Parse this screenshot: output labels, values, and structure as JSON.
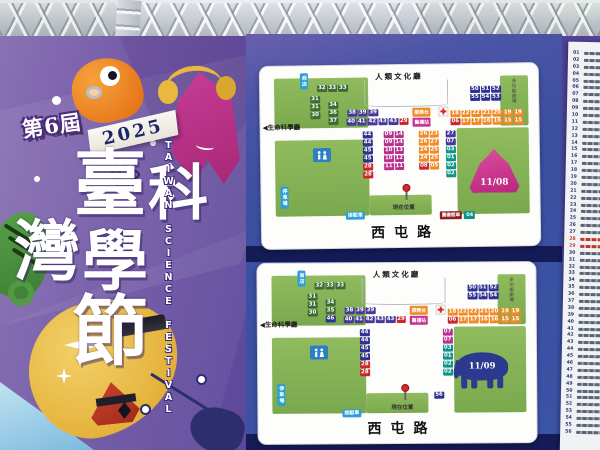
{
  "poster": {
    "edition_badge": "第6屆",
    "year_ribbon": "2025",
    "title_char_1": "臺",
    "title_char_2": "科",
    "title_char_3": "灣",
    "title_char_4": "學",
    "title_char_5": "節",
    "english_vertical": "TAIWAN SCIENCE FESTIVAL"
  },
  "booth_colors": {
    "g": "#3e6b35",
    "n": "#2e3192",
    "p": "#46399b",
    "o": "#f08a24",
    "r": "#c9252c",
    "m": "#b82f8e",
    "t": "#0f9288"
  },
  "maps": [
    {
      "date": "11/08",
      "mascot": "mountain",
      "labels": {
        "hall_top": "人類文化廳",
        "hall_left": "◀生命科學廳",
        "shop": "商店",
        "parking": "停車場",
        "shuttle": "接駁車",
        "service": "服務台",
        "medical": "醫護站",
        "theater": "多功能劇場",
        "current": "現在位置",
        "road": "西屯路",
        "library": "圖書館車",
        "library_no": "04"
      },
      "groups": [
        {
          "name": "shop-row",
          "x": 57,
          "y": 19,
          "cols": 3,
          "cells": [
            [
              "32",
              "g"
            ],
            [
              "33",
              "g"
            ],
            [
              "33",
              "g"
            ]
          ]
        },
        {
          "name": "col-a",
          "x": 50,
          "y": 30,
          "cols": 1,
          "cells": [
            [
              "31",
              "g"
            ],
            [
              "31",
              "g"
            ],
            [
              "30",
              "g"
            ]
          ]
        },
        {
          "name": "col-b",
          "x": 68,
          "y": 36,
          "cols": 1,
          "cells": [
            [
              "34",
              "g"
            ],
            [
              "36",
              "g"
            ],
            [
              "37",
              "g"
            ]
          ]
        },
        {
          "name": "purple-row-1",
          "x": 87,
          "y": 44,
          "cols": 3,
          "cells": [
            [
              "38",
              "p"
            ],
            [
              "39",
              "p"
            ],
            [
              "39",
              "p"
            ]
          ]
        },
        {
          "name": "purple-row-2",
          "x": 86,
          "y": 53,
          "cols": 6,
          "cells": [
            [
              "40",
              "p"
            ],
            [
              "41",
              "p"
            ],
            [
              "42",
              "p"
            ],
            [
              "43",
              "p"
            ],
            [
              "43",
              "p"
            ],
            [
              "29",
              "r"
            ]
          ]
        },
        {
          "name": "navy-grid",
          "x": 210,
          "y": 22,
          "cols": 3,
          "cells": [
            [
              "50",
              "n"
            ],
            [
              "51",
              "n"
            ],
            [
              "52",
              "n"
            ],
            [
              "55",
              "n"
            ],
            [
              "54",
              "n"
            ],
            [
              "53",
              "n"
            ]
          ]
        },
        {
          "name": "orange-grid",
          "x": 190,
          "y": 46,
          "cols": 7,
          "cells": [
            [
              "18",
              "o"
            ],
            [
              "22",
              "o"
            ],
            [
              "22",
              "o"
            ],
            [
              "21",
              "o"
            ],
            [
              "20",
              "o"
            ],
            [
              "19",
              "o"
            ],
            [
              "19",
              "o"
            ],
            [
              "06",
              "r"
            ],
            [
              "17",
              "o"
            ],
            [
              "17",
              "o"
            ],
            [
              "16",
              "o"
            ],
            [
              "16",
              "o"
            ],
            [
              "15",
              "o"
            ],
            [
              "15",
              "o"
            ]
          ]
        },
        {
          "name": "mid-col",
          "x": 102,
          "y": 66,
          "cols": 1,
          "cells": [
            [
              "44",
              "n"
            ],
            [
              "44",
              "n"
            ],
            [
              "45",
              "n"
            ],
            [
              "45",
              "n"
            ],
            [
              "28",
              "r"
            ],
            [
              "28",
              "r"
            ]
          ]
        },
        {
          "name": "pink-pairs",
          "x": 123,
          "y": 66,
          "cols": 2,
          "cells": [
            [
              "09",
              "m"
            ],
            [
              "14",
              "m"
            ],
            [
              "09",
              "m"
            ],
            [
              "14",
              "m"
            ],
            [
              "10",
              "m"
            ],
            [
              "13",
              "m"
            ],
            [
              "10",
              "m"
            ],
            [
              "12",
              "m"
            ],
            [
              "11",
              "m"
            ],
            [
              "11",
              "m"
            ]
          ]
        },
        {
          "name": "orange-pairs",
          "x": 158,
          "y": 66,
          "cols": 2,
          "cells": [
            [
              "26",
              "o"
            ],
            [
              "23",
              "o"
            ],
            [
              "26",
              "o"
            ],
            [
              "27",
              "o"
            ],
            [
              "24",
              "o"
            ],
            [
              "25",
              "o"
            ],
            [
              "24",
              "o"
            ],
            [
              "25",
              "o"
            ],
            [
              "08",
              "r"
            ],
            [
              "05",
              "o"
            ]
          ]
        },
        {
          "name": "right-col",
          "x": 185,
          "y": 66,
          "cols": 1,
          "cells": [
            [
              "27",
              "p"
            ],
            [
              "07",
              "p"
            ],
            [
              "03",
              "t"
            ],
            [
              "01",
              "t"
            ],
            [
              "02",
              "t"
            ],
            [
              "02",
              "t"
            ]
          ]
        }
      ]
    },
    {
      "date": "11/09",
      "mascot": "elephant",
      "labels": {
        "hall_top": "人類文化廳",
        "hall_left": "◀生命科學廳",
        "shop": "商店",
        "parking": "停車場",
        "shuttle": "接駁車",
        "service": "服務台",
        "medical": "醫護站",
        "theater": "多功能劇場",
        "current": "現在位置",
        "road": "西屯路"
      },
      "groups": [
        {
          "name": "shop-row",
          "x": 57,
          "y": 19,
          "cols": 3,
          "cells": [
            [
              "32",
              "g"
            ],
            [
              "33",
              "g"
            ],
            [
              "33",
              "g"
            ]
          ]
        },
        {
          "name": "col-a",
          "x": 50,
          "y": 30,
          "cols": 1,
          "cells": [
            [
              "31",
              "g"
            ],
            [
              "31",
              "g"
            ],
            [
              "30",
              "g"
            ]
          ]
        },
        {
          "name": "col-b",
          "x": 68,
          "y": 36,
          "cols": 1,
          "cells": [
            [
              "34",
              "g"
            ],
            [
              "35",
              "g"
            ],
            [
              "46",
              "n"
            ]
          ]
        },
        {
          "name": "purple-row-1",
          "x": 87,
          "y": 44,
          "cols": 3,
          "cells": [
            [
              "38",
              "p"
            ],
            [
              "39",
              "p"
            ],
            [
              "39",
              "p"
            ]
          ]
        },
        {
          "name": "purple-row-2",
          "x": 86,
          "y": 53,
          "cols": 6,
          "cells": [
            [
              "40",
              "p"
            ],
            [
              "41",
              "p"
            ],
            [
              "42",
              "p"
            ],
            [
              "43",
              "p"
            ],
            [
              "43",
              "p"
            ],
            [
              "29",
              "r"
            ]
          ]
        },
        {
          "name": "navy-grid",
          "x": 210,
          "y": 22,
          "cols": 3,
          "cells": [
            [
              "50",
              "n"
            ],
            [
              "51",
              "n"
            ],
            [
              "52",
              "n"
            ],
            [
              "55",
              "n"
            ],
            [
              "54",
              "n"
            ],
            [
              "54",
              "n"
            ]
          ]
        },
        {
          "name": "orange-grid",
          "x": 190,
          "y": 46,
          "cols": 7,
          "cells": [
            [
              "18",
              "o"
            ],
            [
              "22",
              "o"
            ],
            [
              "22",
              "o"
            ],
            [
              "21",
              "o"
            ],
            [
              "20",
              "o"
            ],
            [
              "19",
              "o"
            ],
            [
              "19",
              "o"
            ],
            [
              "06",
              "r"
            ],
            [
              "17",
              "o"
            ],
            [
              "17",
              "o"
            ],
            [
              "16",
              "o"
            ],
            [
              "16",
              "o"
            ],
            [
              "15",
              "o"
            ],
            [
              "15",
              "o"
            ]
          ]
        },
        {
          "name": "mid-col",
          "x": 102,
          "y": 66,
          "cols": 1,
          "cells": [
            [
              "44",
              "n"
            ],
            [
              "44",
              "n"
            ],
            [
              "45",
              "n"
            ],
            [
              "45",
              "n"
            ],
            [
              "28",
              "r"
            ],
            [
              "28",
              "r"
            ]
          ]
        },
        {
          "name": "right-col",
          "x": 185,
          "y": 66,
          "cols": 1,
          "cells": [
            [
              "07",
              "m"
            ],
            [
              "07",
              "m"
            ],
            [
              "03",
              "t"
            ],
            [
              "01",
              "t"
            ],
            [
              "02",
              "t"
            ],
            [
              "02",
              "t"
            ]
          ]
        },
        {
          "name": "pin-56",
          "x": 176,
          "y": 129,
          "cols": 1,
          "cells": [
            [
              "56",
              "n"
            ]
          ]
        }
      ]
    }
  ],
  "legend": {
    "numbers": [
      "01",
      "02",
      "03",
      "04",
      "05",
      "06",
      "07",
      "08",
      "09",
      "10",
      "11",
      "12",
      "13",
      "14",
      "15",
      "16",
      "17",
      "18",
      "19",
      "20",
      "21",
      "22",
      "23",
      "24",
      "25",
      "26",
      "27",
      "28",
      "29",
      "30",
      "31",
      "32",
      "33",
      "34",
      "35",
      "36",
      "37",
      "38",
      "39",
      "40",
      "41",
      "42",
      "43",
      "44",
      "45",
      "46",
      "47",
      "48",
      "49",
      "50",
      "51",
      "52",
      "53",
      "54",
      "55",
      "56"
    ],
    "red_numbers": [
      "28",
      "29"
    ]
  }
}
